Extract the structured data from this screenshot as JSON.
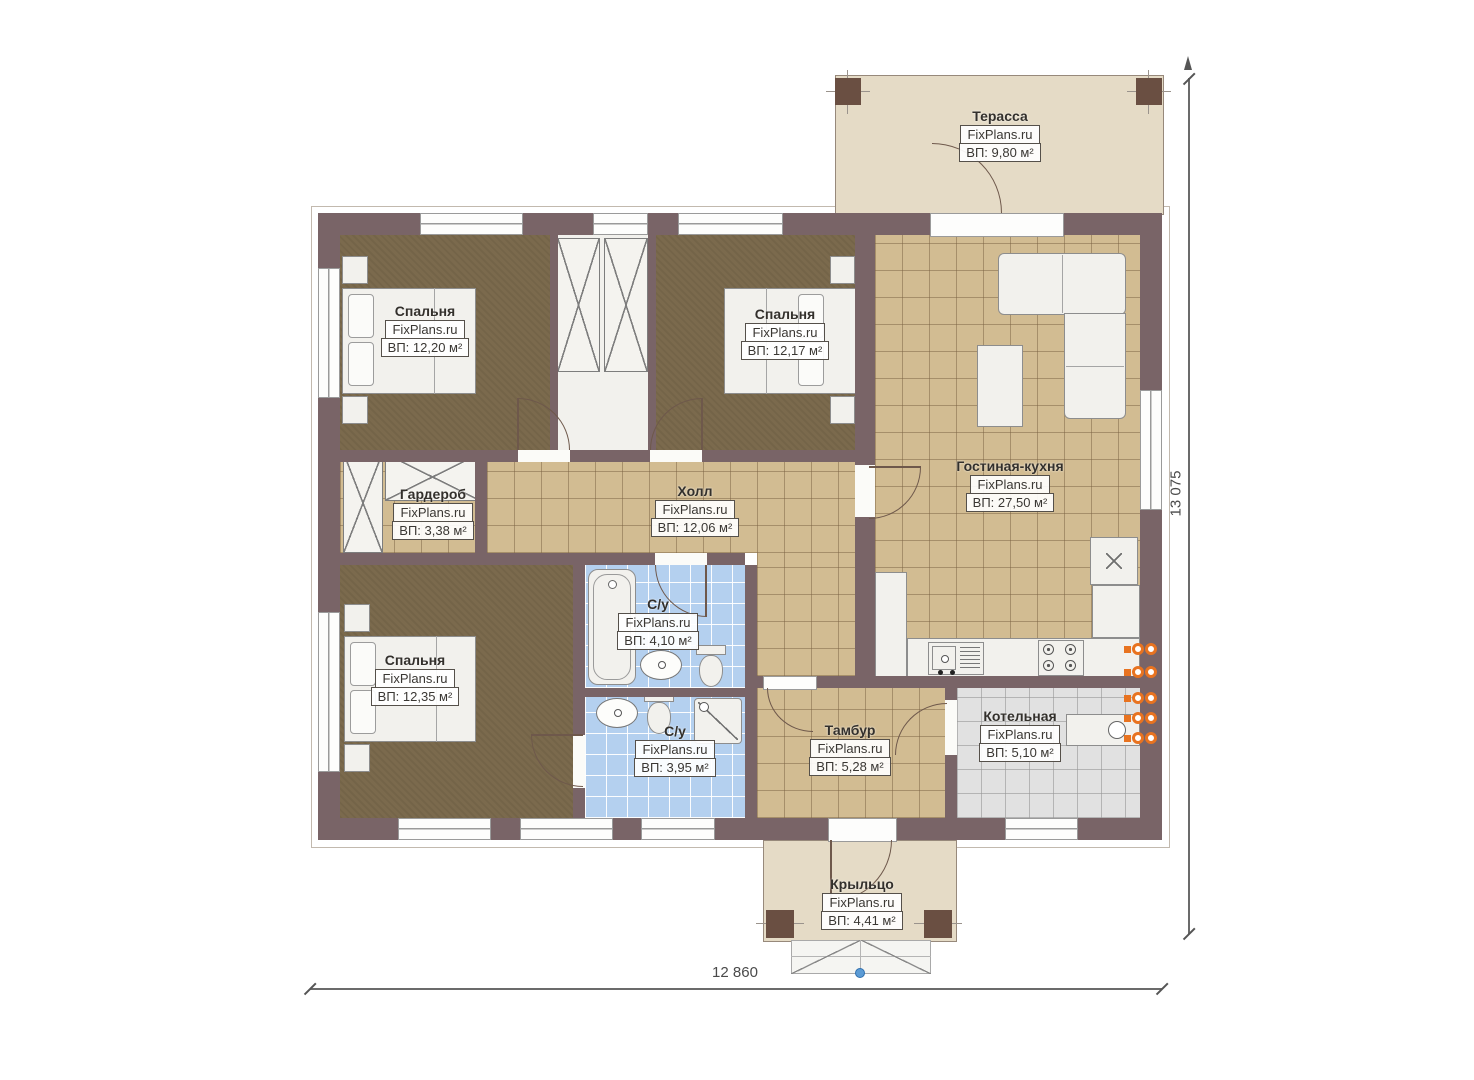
{
  "plan": {
    "watermark": "FixPlans.ru",
    "rooms": [
      {
        "name": "Терасса",
        "watermark": "FixPlans.ru",
        "area": "ВП: 9,80 м²"
      },
      {
        "name": "Спальня",
        "watermark": "FixPlans.ru",
        "area": "ВП: 12,20 м²"
      },
      {
        "name": "Спальня",
        "watermark": "FixPlans.ru",
        "area": "ВП: 12,17 м²"
      },
      {
        "name": "Гостиная-кухня",
        "watermark": "FixPlans.ru",
        "area": "ВП: 27,50 м²"
      },
      {
        "name": "Гардероб",
        "watermark": "FixPlans.ru",
        "area": "ВП: 3,38 м²"
      },
      {
        "name": "Холл",
        "watermark": "FixPlans.ru",
        "area": "ВП: 12,06 м²"
      },
      {
        "name": "С/у",
        "watermark": "FixPlans.ru",
        "area": "ВП: 4,10 м²"
      },
      {
        "name": "Спальня",
        "watermark": "FixPlans.ru",
        "area": "ВП: 12,35 м²"
      },
      {
        "name": "С/у",
        "watermark": "FixPlans.ru",
        "area": "ВП: 3,95 м²"
      },
      {
        "name": "Тамбур",
        "watermark": "FixPlans.ru",
        "area": "ВП: 5,28 м²"
      },
      {
        "name": "Котельная",
        "watermark": "FixPlans.ru",
        "area": "ВП: 5,10 м²"
      },
      {
        "name": "Крыльцо",
        "watermark": "FixPlans.ru",
        "area": "ВП: 4,41 м²"
      }
    ],
    "dimensions": {
      "width": "12 860",
      "height": "13 075"
    },
    "colors": {
      "wall": "#796467",
      "bedroom_floor": "#7b6a4d",
      "tile_floor": "#d2bc92",
      "bath_tile": "#b4d0ef",
      "boiler_tile": "#e1e1e1",
      "outdoor_floor": "#e5dbc6",
      "radiator_accent": "#e87320",
      "marker_blue": "#5b9bd5"
    }
  }
}
